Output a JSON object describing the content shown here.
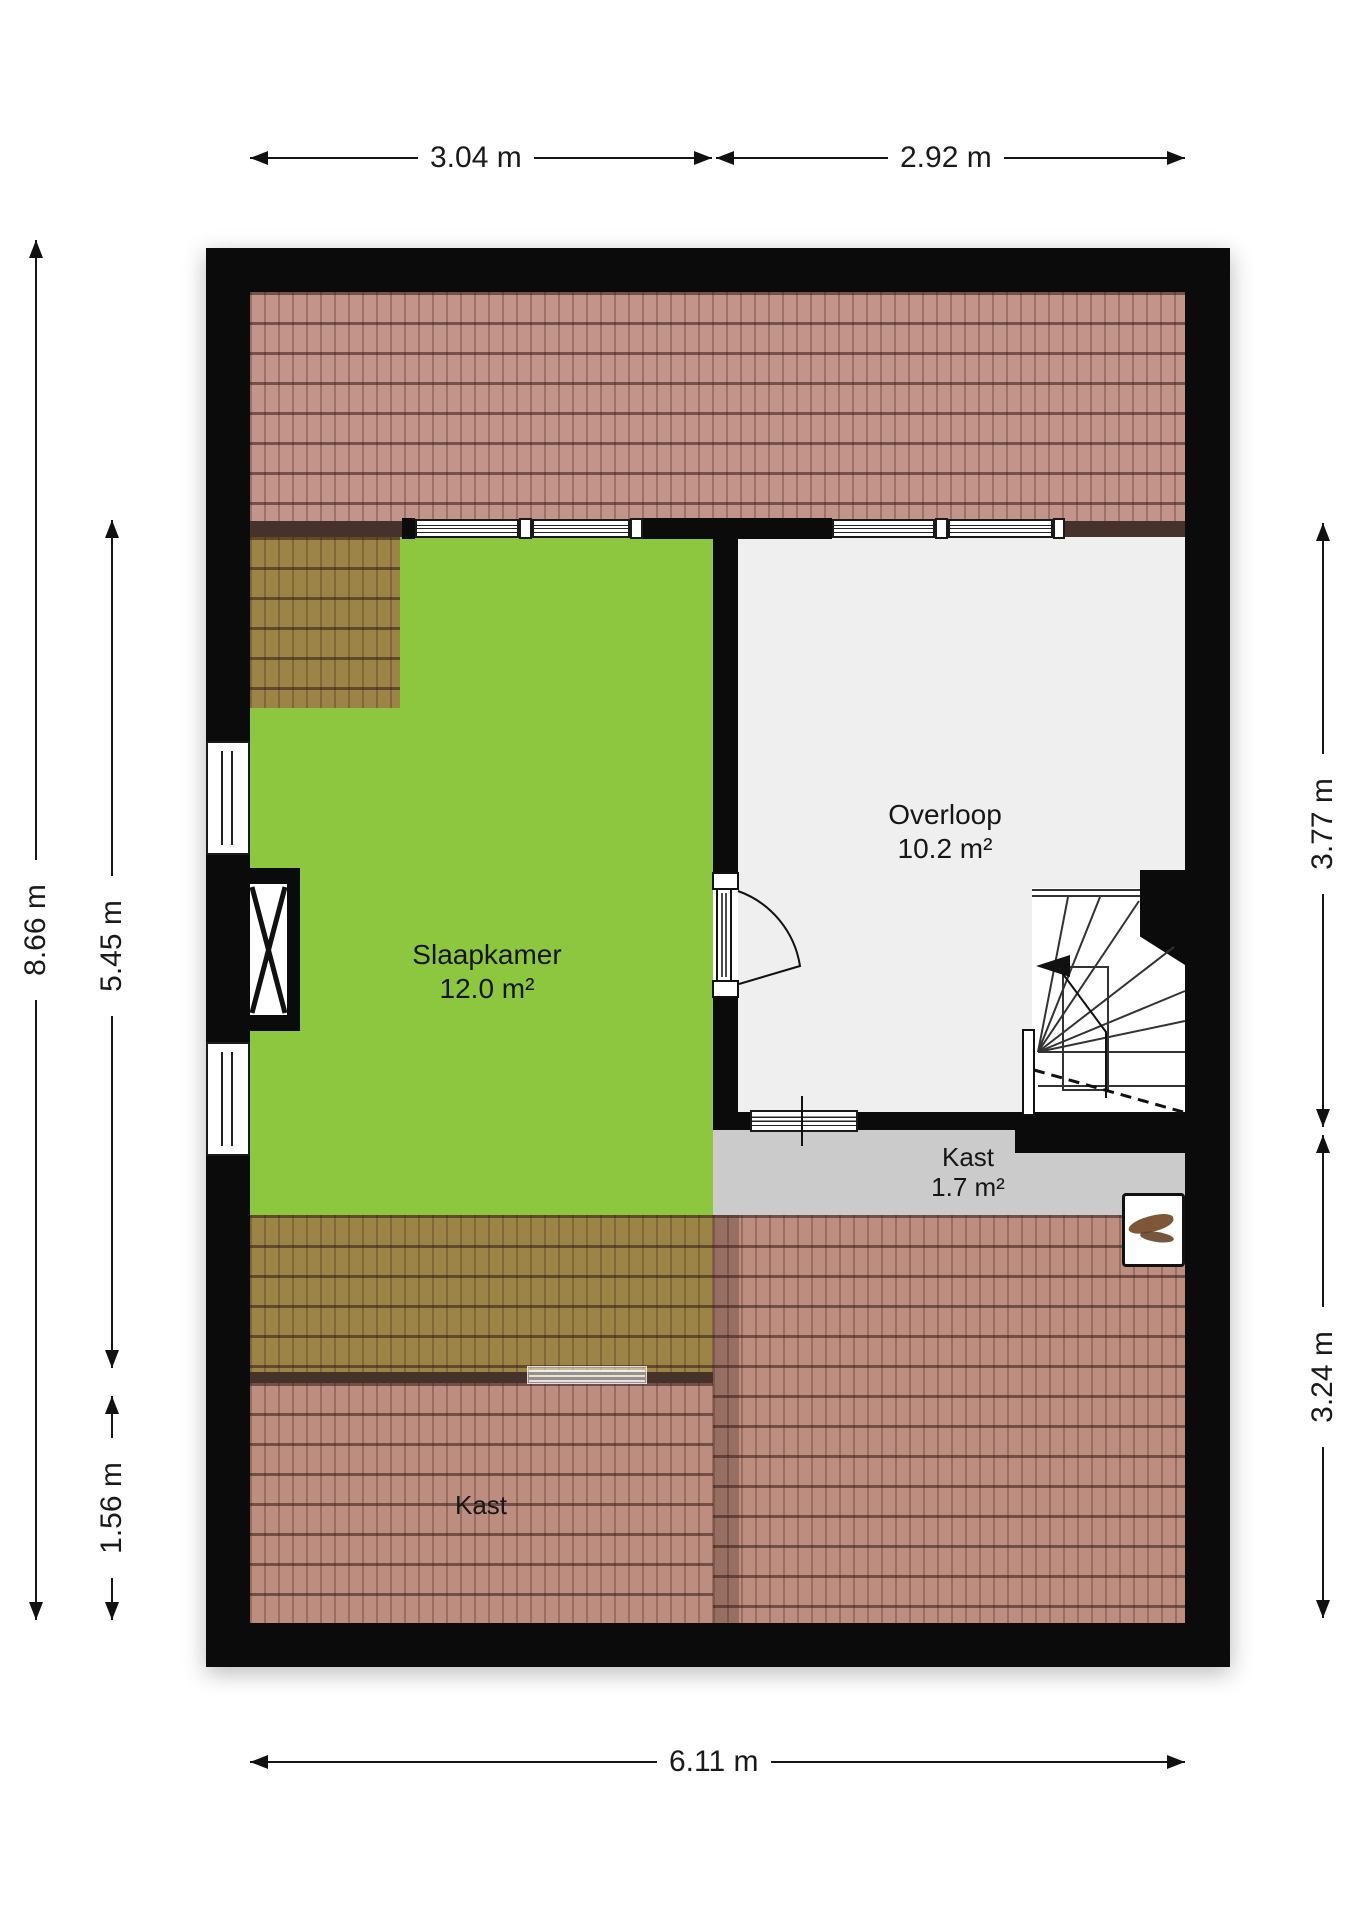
{
  "plan": {
    "type": "floorplan",
    "floor_name": "attic",
    "rooms": {
      "slaapkamer": {
        "name": "Slaapkamer",
        "area": "12.0 m²"
      },
      "overloop": {
        "name": "Overloop",
        "area": "10.2 m²"
      },
      "kast_small": {
        "name": "Kast",
        "area": "1.7 m²"
      },
      "kast_attic": {
        "name": "Kast"
      }
    },
    "dimensions": {
      "top": [
        {
          "label": "3.04 m"
        },
        {
          "label": "2.92 m"
        }
      ],
      "bottom": [
        {
          "label": "6.11 m"
        }
      ],
      "left": [
        {
          "label": "8.66 m"
        },
        {
          "label": "5.45 m"
        },
        {
          "label": "1.56 m"
        }
      ],
      "right": [
        {
          "label": "3.77 m"
        },
        {
          "label": "3.24 m"
        }
      ]
    },
    "colors": {
      "wall": "#0b0b0b",
      "slaapkamer_floor": "#8dc63f",
      "overloop_floor": "#efefef",
      "kast_floor": "#cbcbcb",
      "roof_band": "#c2948a",
      "roof_over_room": "#9c8446",
      "roof_lower": "#bd8e80",
      "dimension_color": "#161616"
    },
    "symbols": [
      "door-swing-icon",
      "stairs-winder-icon",
      "stairs-direction-arrow-icon",
      "shaft-cross-icon",
      "window-icon",
      "roof-window-icon"
    ]
  }
}
